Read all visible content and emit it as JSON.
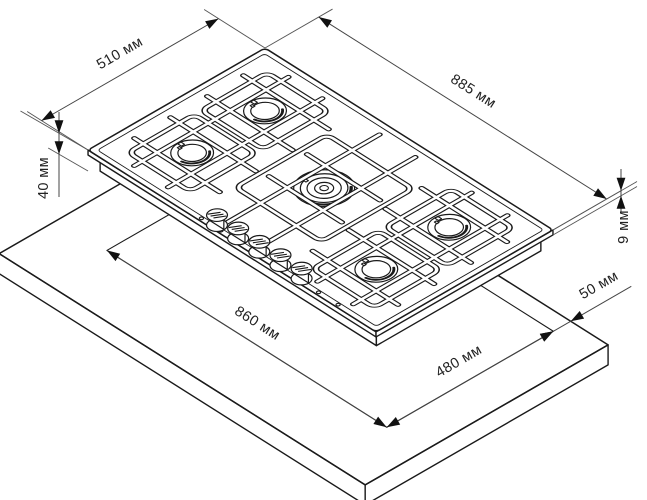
{
  "page": {
    "background": "#ffffff",
    "line_color": "#1a1a1a",
    "thin_line_color": "#555555",
    "text_color": "#222222"
  },
  "diagram": {
    "kind": "gas-hob-installation-dimension-drawing",
    "units": "мм",
    "burner_count": 5,
    "knob_count": 5,
    "dimensions": [
      {
        "id": "hob-depth",
        "label": "510 мм",
        "value": 510
      },
      {
        "id": "hob-width",
        "label": "885 мм",
        "value": 885
      },
      {
        "id": "hob-body-height",
        "label": "40 мм",
        "value": 40
      },
      {
        "id": "hob-rim-height",
        "label": "9 мм",
        "value": 9
      },
      {
        "id": "cutout-width",
        "label": "860 мм",
        "value": 860
      },
      {
        "id": "cutout-depth",
        "label": "480 мм",
        "value": 480
      },
      {
        "id": "cutout-edge-clearance",
        "label": "50 мм",
        "value": 50
      }
    ]
  }
}
